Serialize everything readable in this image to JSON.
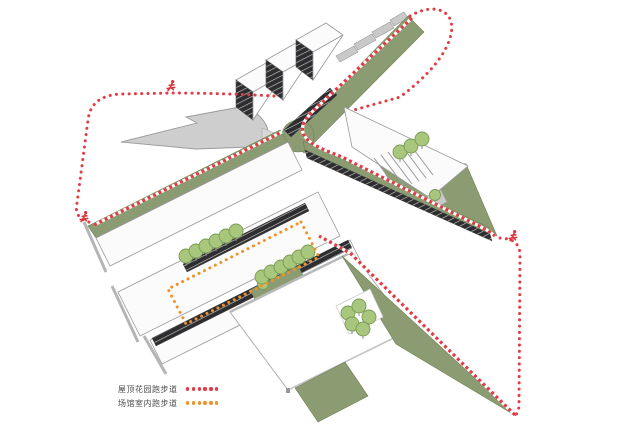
{
  "diagram": {
    "kind": "architectural-axonometric-site-diagram",
    "legend": {
      "items": [
        {
          "label": "屋顶花园跑步道",
          "color": "#e23b44",
          "line_style": "dotted"
        },
        {
          "label": "场馆室内跑步道",
          "color": "#ef9329",
          "line_style": "dotted"
        }
      ]
    },
    "colors": {
      "roof_garden_track": "#e23b44",
      "indoor_track": "#ef9329",
      "green_roof": "#8c9c72",
      "tree": "#a8c77c",
      "plaza_grey": "#cecece",
      "dark_facade": "#2d2d30",
      "background": "#ffffff"
    },
    "icons": {
      "runner": "runner-icon"
    },
    "runner_marker_count": 3
  }
}
